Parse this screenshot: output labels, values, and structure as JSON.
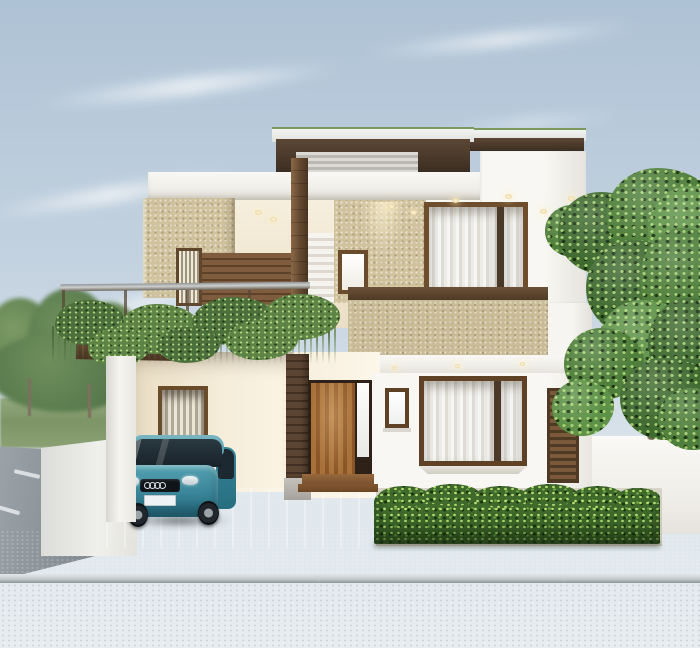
{
  "scene": {
    "type": "architectural-exterior-rendering",
    "description": "Photorealistic 3D render of a modern two-storey house: white and speckled-beige walls with dark wood accents, flat layered roof with thin green edge, upper balcony with glass railing and trailing planter vines, curtained wood-framed windows, covered carport with a teal compact hatchback, wooden entry door beside a brick pillar, trimmed hedge, large green tree at right, street with sidewalk in front and a side road with trees at left",
    "time_of_day": "soft overcast daylight",
    "weather": "hazy blue sky with wispy clouds"
  },
  "car": {
    "style": "compact hatchback",
    "badge": "four-ring emblem",
    "body_color": "#3a8599",
    "license_plate_text": ""
  },
  "palette": {
    "sky_top": "#aec2d5",
    "sky_bottom": "#e8edf1",
    "wall_white": "#f5f3ee",
    "wall_cream_lit": "#f6eedb",
    "wall_speckle_beige": "#cfc29d",
    "wall_speckle_khaki": "#c8bb96",
    "roof_edge_green": "#7d9a5e",
    "wood_fascia_dark": "#4a3a2c",
    "wood_door": "#9a6632",
    "wood_frame": "#6e4e2c",
    "vine_green": "#4c703c",
    "tree_green": "#4f7f3c",
    "hedge_green": "#3f6a2c",
    "car_teal": "#3a8599",
    "sidewalk_gray": "#a9b0b5",
    "road_gray": "#7c848c",
    "curb_white": "#e3e6e8",
    "floor_ivory": "#e9e0cd",
    "glass_railing": "#d8e4e8"
  },
  "objects": [
    {
      "name": "sky",
      "desc": "pale blue gradient with wispy cloud streaks"
    },
    {
      "name": "background-trees",
      "desc": "blurred green trees and grass strip at far left"
    },
    {
      "name": "side-road",
      "desc": "perspective road with white lane dashes at left"
    },
    {
      "name": "layered-flat-roof",
      "desc": "white slabs, green trim line, dark wood fascia, ribbed band"
    },
    {
      "name": "upper-balcony",
      "desc": "open balcony with glass railing and wood posts"
    },
    {
      "name": "trailing-plants",
      "desc": "vines cascading from balcony planters"
    },
    {
      "name": "wood-column",
      "desc": "dark wood clad column through both floors"
    },
    {
      "name": "upper-curtained-window",
      "desc": "large wood-framed window with sheer white curtains"
    },
    {
      "name": "parapet",
      "desc": "wood-capped speckled khaki parapet band"
    },
    {
      "name": "carport",
      "desc": "covered parking bay with cream wall and blind window"
    },
    {
      "name": "car",
      "desc": "teal hatchback parked facing the street"
    },
    {
      "name": "entry-door",
      "desc": "tall wooden plank door with sidelight and wood steps"
    },
    {
      "name": "brick-pillar",
      "desc": "dark brick porch pillar on concrete base"
    },
    {
      "name": "lower-bay-window",
      "desc": "curtained wood bay window"
    },
    {
      "name": "louver-panel",
      "desc": "vertical dark wood louvered panel"
    },
    {
      "name": "hedge",
      "desc": "dense trimmed green hedge along the right frontage"
    },
    {
      "name": "tree",
      "desc": "large leafy green tree at the right"
    },
    {
      "name": "boundary-walls",
      "desc": "low white compound walls left and right"
    },
    {
      "name": "sidewalk",
      "desc": "gray concrete sidewalk with white curb line"
    },
    {
      "name": "street",
      "desc": "asphalt road across the foreground"
    }
  ]
}
